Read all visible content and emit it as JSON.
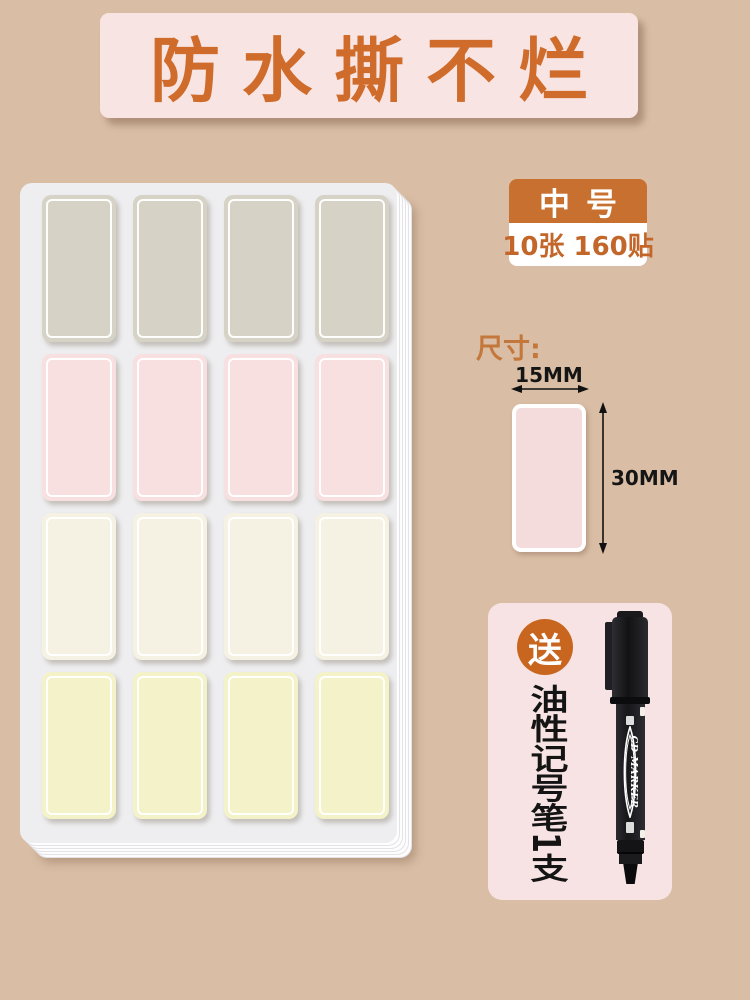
{
  "page": {
    "background": "#d9bda5"
  },
  "banner": {
    "text": "防水撕不烂",
    "bg": "#f8e4e2",
    "text_color": "#cf6c2c"
  },
  "label_sheet": {
    "columns": 4,
    "rows": [
      {
        "name": "gray-labels",
        "color": "#d6d3c6"
      },
      {
        "name": "pink-labels",
        "color": "#f8dfe0"
      },
      {
        "name": "cream-labels",
        "color": "#f6f2e3"
      },
      {
        "name": "yellow-labels",
        "color": "#f4f2c9"
      }
    ]
  },
  "size_badge": {
    "size": "中号",
    "count": "10张 160贴",
    "bg": "#c8702f",
    "count_color": "#c2662a"
  },
  "dimensions": {
    "heading": "尺寸:",
    "width": "15MM",
    "height": "30MM",
    "sticker_color": "#f5dcdc"
  },
  "gift": {
    "badge": "送",
    "badge_bg": "#c8661f",
    "text": "油性记号笔1支",
    "pen_text": "CD MARKER",
    "card_bg": "#f7e3e3"
  }
}
